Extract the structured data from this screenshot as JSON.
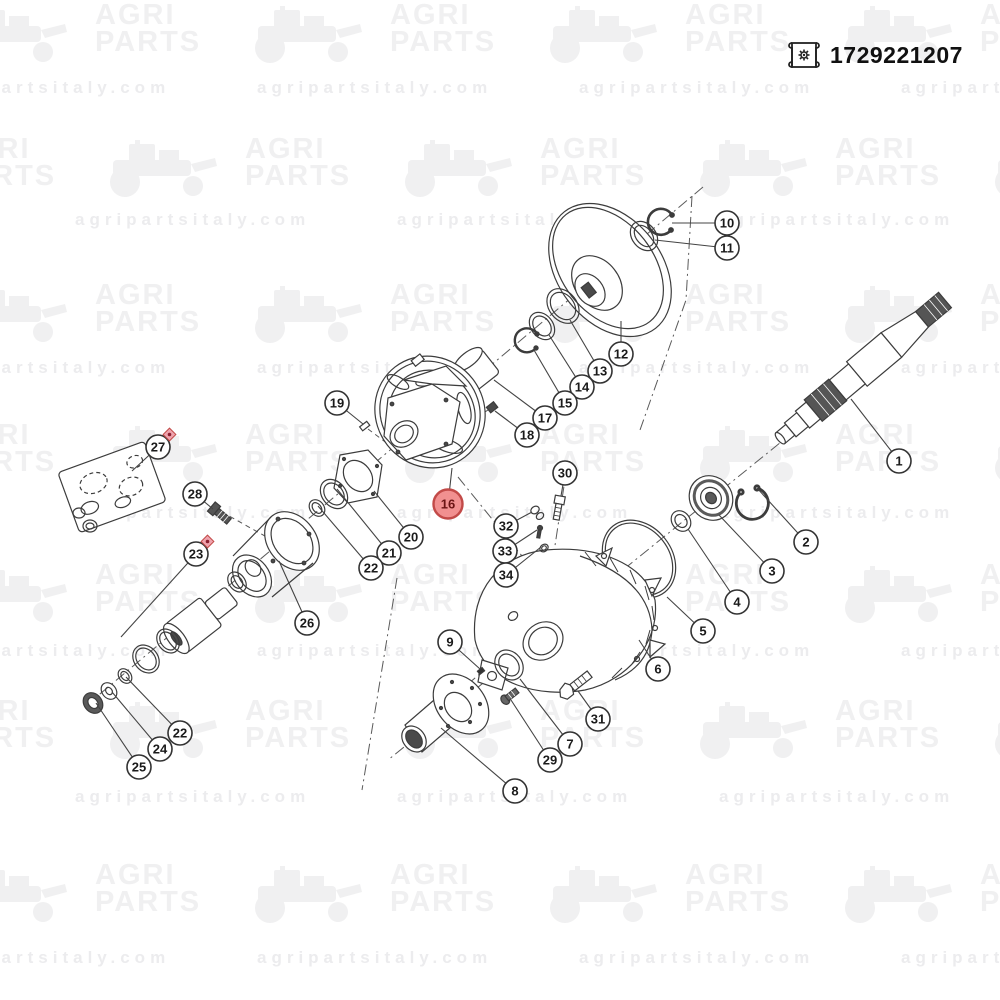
{
  "header": {
    "part_number": "1729221207",
    "icon": "drawing-scroll-icon"
  },
  "watermark": {
    "brand_line1": "AGRI",
    "brand_line2": "PARTS",
    "url": "agripartsitaly.com",
    "brand_color": "#f0f0f1",
    "url_color": "#ececee",
    "logo_row_ys": [
      2,
      136,
      282,
      422,
      562,
      698,
      862
    ],
    "url_row_ys": [
      78,
      210,
      358,
      503,
      641,
      787,
      948
    ]
  },
  "diagram": {
    "highlight_color": "#f19090",
    "highlight_border": "#c24a48",
    "marker_color": "#efa3ae",
    "marker_dot": "#8c2030",
    "line_color": "#3c3c3c",
    "callouts": [
      {
        "label": "1",
        "x": 899,
        "y": 461,
        "tx": 851,
        "ty": 399
      },
      {
        "label": "2",
        "x": 806,
        "y": 542,
        "tx": 757,
        "ty": 488
      },
      {
        "label": "3",
        "x": 772,
        "y": 571,
        "tx": 719,
        "ty": 515
      },
      {
        "label": "4",
        "x": 737,
        "y": 602,
        "tx": 688,
        "ty": 529
      },
      {
        "label": "5",
        "x": 703,
        "y": 631,
        "tx": 667,
        "ty": 597
      },
      {
        "label": "6",
        "x": 658,
        "y": 669,
        "tx": 639,
        "ty": 640
      },
      {
        "label": "7",
        "x": 570,
        "y": 744,
        "tx": 520,
        "ty": 679
      },
      {
        "label": "8",
        "x": 515,
        "y": 791,
        "tx": 441,
        "ty": 728
      },
      {
        "label": "9",
        "x": 450,
        "y": 642,
        "tx": 480,
        "ty": 669
      },
      {
        "label": "10",
        "x": 727,
        "y": 223,
        "tx": 672,
        "ty": 223
      },
      {
        "label": "11",
        "x": 727,
        "y": 248,
        "tx": 655,
        "ty": 240
      },
      {
        "label": "12",
        "x": 621,
        "y": 354,
        "tx": 621,
        "ty": 321
      },
      {
        "label": "13",
        "x": 600,
        "y": 371,
        "tx": 570,
        "ty": 320
      },
      {
        "label": "14",
        "x": 582,
        "y": 387,
        "tx": 549,
        "ty": 335
      },
      {
        "label": "15",
        "x": 565,
        "y": 403,
        "tx": 534,
        "ty": 350
      },
      {
        "label": "16",
        "x": 448,
        "y": 504,
        "tx": 452,
        "ty": 468,
        "highlight": true
      },
      {
        "label": "17",
        "x": 545,
        "y": 418,
        "tx": 494,
        "ty": 380
      },
      {
        "label": "18",
        "x": 527,
        "y": 435,
        "tx": 495,
        "ty": 411
      },
      {
        "label": "19",
        "x": 337,
        "y": 403,
        "tx": 363,
        "ty": 424
      },
      {
        "label": "20",
        "x": 411,
        "y": 537,
        "tx": 374,
        "ty": 491
      },
      {
        "label": "21",
        "x": 389,
        "y": 553,
        "tx": 337,
        "ty": 489
      },
      {
        "label": "22",
        "x": 371,
        "y": 568,
        "tx": 318,
        "ty": 506
      },
      {
        "label": "23",
        "x": 196,
        "y": 554,
        "tx": 121,
        "ty": 637,
        "marker": true
      },
      {
        "label": "24",
        "x": 160,
        "y": 749,
        "tx": 112,
        "ty": 692
      },
      {
        "label": "25",
        "x": 139,
        "y": 767,
        "tx": 96,
        "ty": 703
      },
      {
        "label": "26",
        "x": 307,
        "y": 623,
        "tx": 279,
        "ty": 561
      },
      {
        "label": "27",
        "x": 158,
        "y": 447,
        "tx": 132,
        "ty": 471,
        "marker": true
      },
      {
        "label": "28",
        "x": 195,
        "y": 494,
        "tx": 213,
        "ty": 509
      },
      {
        "label": "29",
        "x": 550,
        "y": 760,
        "tx": 511,
        "ty": 700
      },
      {
        "label": "30",
        "x": 565,
        "y": 473,
        "tx": 561,
        "ty": 496
      },
      {
        "label": "31",
        "x": 598,
        "y": 719,
        "tx": 578,
        "ty": 691
      },
      {
        "label": "32",
        "x": 506,
        "y": 526,
        "tx": 532,
        "ty": 512
      },
      {
        "label": "33",
        "x": 505,
        "y": 551,
        "tx": 537,
        "ty": 530
      },
      {
        "label": "34",
        "x": 506,
        "y": 575,
        "tx": 541,
        "ty": 547
      },
      {
        "label": "22",
        "x": 180,
        "y": 733,
        "tx": 126,
        "ty": 677
      }
    ]
  }
}
